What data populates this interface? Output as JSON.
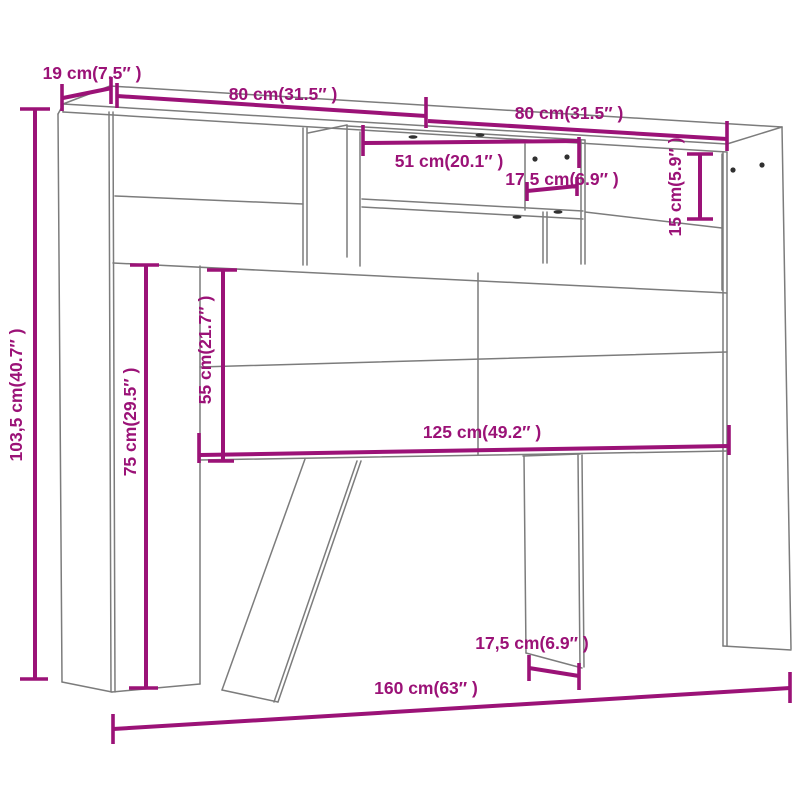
{
  "colors": {
    "dimension": "#9B1277",
    "outline": "#7C7C7C",
    "hardware": "#303030"
  },
  "dimensions": {
    "top_depth": "19 cm(7.5″ )",
    "top_width_left": "80 cm(31.5″ )",
    "top_width_right": "80 cm(31.5″ )",
    "shelf_width": "51 cm(20.1″ )",
    "cubby_width": "17,5 cm(6.9″ )",
    "compartment_height": "15 cm(5.9″ )",
    "total_height": "103,5 cm(40.7″ )",
    "panel_height": "55 cm(21.7″ )",
    "clearance_height": "75 cm(29.5″ )",
    "inner_width": "125 cm(49.2″ )",
    "leg_depth": "17,5 cm(6.9″ )",
    "total_width": "160 cm(63″ )"
  }
}
